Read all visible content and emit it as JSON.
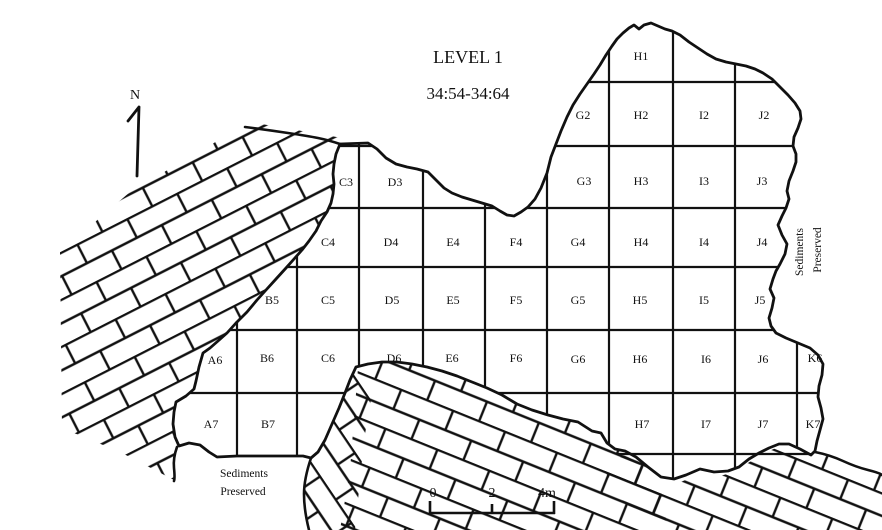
{
  "title": {
    "line1": "LEVEL 1",
    "line2": "34:54-34:64"
  },
  "north_arrow": {
    "label": "N"
  },
  "scale_bar": {
    "tick_labels": [
      "0",
      "2",
      "4m"
    ]
  },
  "notes": {
    "sediments_right": [
      "Sediments",
      "Preserved"
    ],
    "sediments_bottom": [
      "Sediments",
      "Preserved"
    ]
  },
  "grid": {
    "columns": [
      "A",
      "B",
      "C",
      "D",
      "E",
      "F",
      "G",
      "H",
      "I",
      "J",
      "K"
    ],
    "rows": [
      "1",
      "2",
      "3",
      "4",
      "5",
      "6",
      "7"
    ],
    "cells": [
      {
        "id": "H1",
        "x": 641,
        "y": 57
      },
      {
        "id": "G2",
        "x": 583,
        "y": 116
      },
      {
        "id": "H2",
        "x": 641,
        "y": 116
      },
      {
        "id": "I2",
        "x": 704,
        "y": 116
      },
      {
        "id": "J2",
        "x": 764,
        "y": 116
      },
      {
        "id": "C3",
        "x": 346,
        "y": 183
      },
      {
        "id": "D3",
        "x": 395,
        "y": 183
      },
      {
        "id": "G3",
        "x": 584,
        "y": 182
      },
      {
        "id": "H3",
        "x": 641,
        "y": 182
      },
      {
        "id": "I3",
        "x": 704,
        "y": 182
      },
      {
        "id": "J3",
        "x": 762,
        "y": 182
      },
      {
        "id": "C4",
        "x": 328,
        "y": 243
      },
      {
        "id": "D4",
        "x": 391,
        "y": 243
      },
      {
        "id": "E4",
        "x": 453,
        "y": 243
      },
      {
        "id": "F4",
        "x": 516,
        "y": 243
      },
      {
        "id": "G4",
        "x": 578,
        "y": 243
      },
      {
        "id": "H4",
        "x": 641,
        "y": 243
      },
      {
        "id": "I4",
        "x": 704,
        "y": 243
      },
      {
        "id": "J4",
        "x": 762,
        "y": 243
      },
      {
        "id": "B5",
        "x": 272,
        "y": 301
      },
      {
        "id": "C5",
        "x": 328,
        "y": 301
      },
      {
        "id": "D5",
        "x": 392,
        "y": 301
      },
      {
        "id": "E5",
        "x": 453,
        "y": 301
      },
      {
        "id": "F5",
        "x": 516,
        "y": 301
      },
      {
        "id": "G5",
        "x": 578,
        "y": 301
      },
      {
        "id": "H5",
        "x": 640,
        "y": 301
      },
      {
        "id": "I5",
        "x": 704,
        "y": 301
      },
      {
        "id": "J5",
        "x": 760,
        "y": 301
      },
      {
        "id": "A6",
        "x": 215,
        "y": 361
      },
      {
        "id": "B6",
        "x": 267,
        "y": 359
      },
      {
        "id": "C6",
        "x": 328,
        "y": 359
      },
      {
        "id": "D6",
        "x": 394,
        "y": 359
      },
      {
        "id": "E6",
        "x": 452,
        "y": 359
      },
      {
        "id": "F6",
        "x": 516,
        "y": 359
      },
      {
        "id": "G6",
        "x": 578,
        "y": 360
      },
      {
        "id": "H6",
        "x": 640,
        "y": 360
      },
      {
        "id": "I6",
        "x": 706,
        "y": 360
      },
      {
        "id": "J6",
        "x": 763,
        "y": 360
      },
      {
        "id": "K6",
        "x": 815,
        "y": 359
      },
      {
        "id": "A7",
        "x": 211,
        "y": 425
      },
      {
        "id": "B7",
        "x": 268,
        "y": 425
      },
      {
        "id": "H7",
        "x": 642,
        "y": 425
      },
      {
        "id": "I7",
        "x": 706,
        "y": 425
      },
      {
        "id": "J7",
        "x": 763,
        "y": 425
      },
      {
        "id": "K7",
        "x": 813,
        "y": 425
      }
    ]
  }
}
